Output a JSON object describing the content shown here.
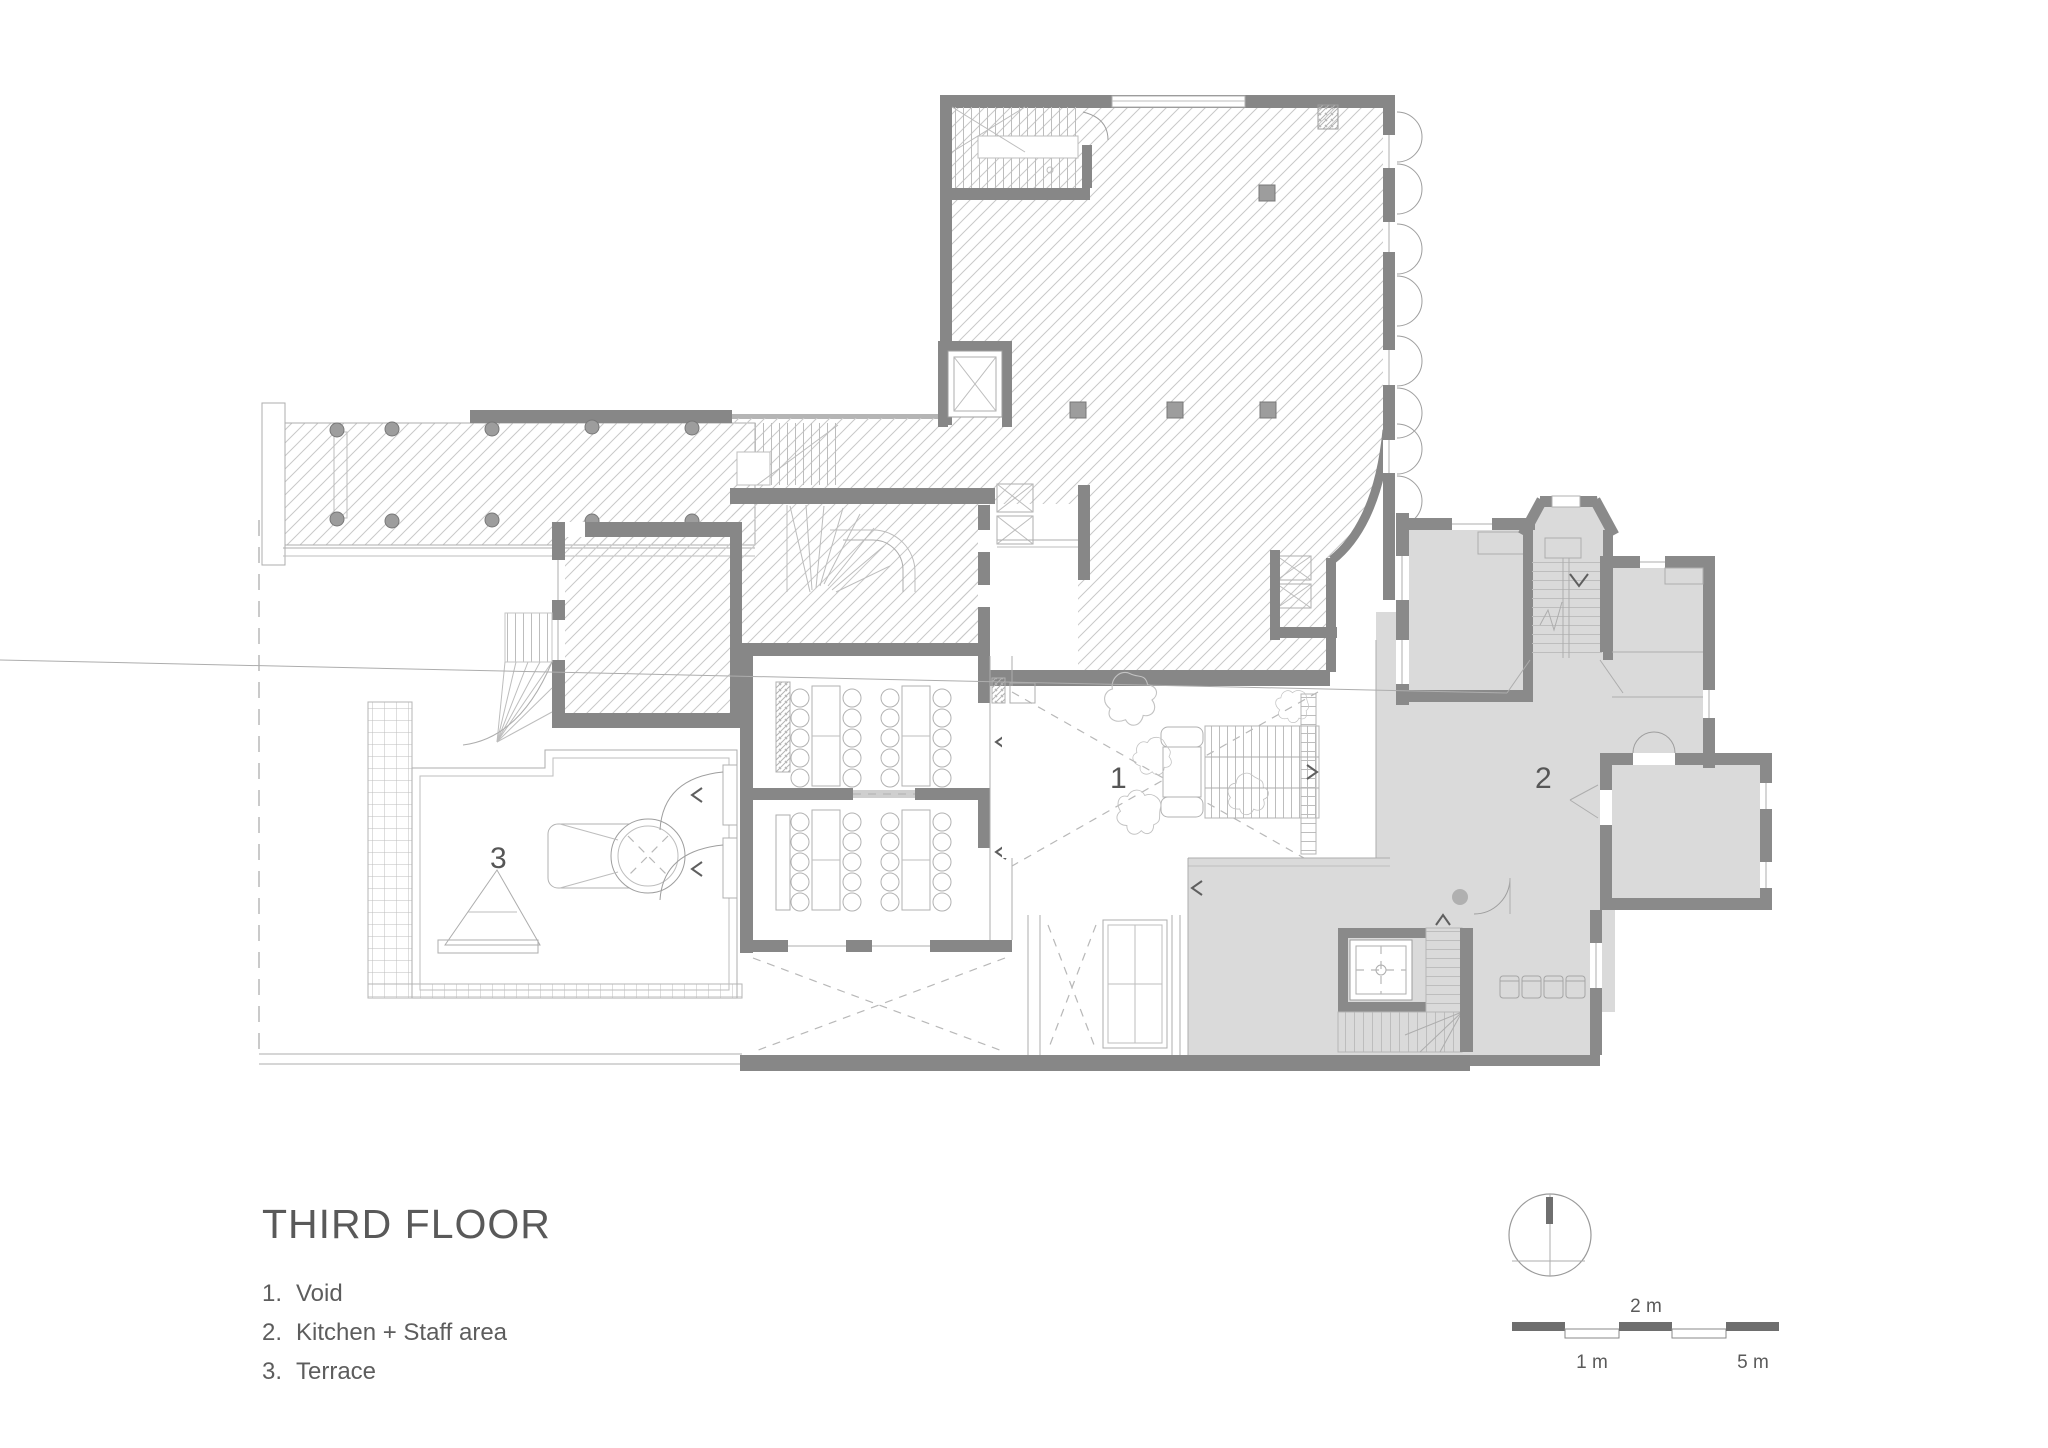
{
  "title": "THIRD FLOOR",
  "legend": {
    "items": [
      {
        "number": "1.",
        "label": "Void"
      },
      {
        "number": "2.",
        "label": "Kitchen + Staff area"
      },
      {
        "number": "3.",
        "label": "Terrace"
      }
    ]
  },
  "plan_labels": {
    "void": "1",
    "kitchen_staff": "2",
    "terrace": "3"
  },
  "scale_bar": {
    "mid_label": "2 m",
    "left_label": "1 m",
    "right_label": "5 m"
  },
  "colors": {
    "wall": "#878787",
    "wing_wall": "#8a8a8a",
    "room_fill": "#dadada",
    "hatch_line": "#c9c9c9",
    "thin_line": "#adadad",
    "text": "#595959",
    "scale_dark": "#6e6e6e"
  }
}
